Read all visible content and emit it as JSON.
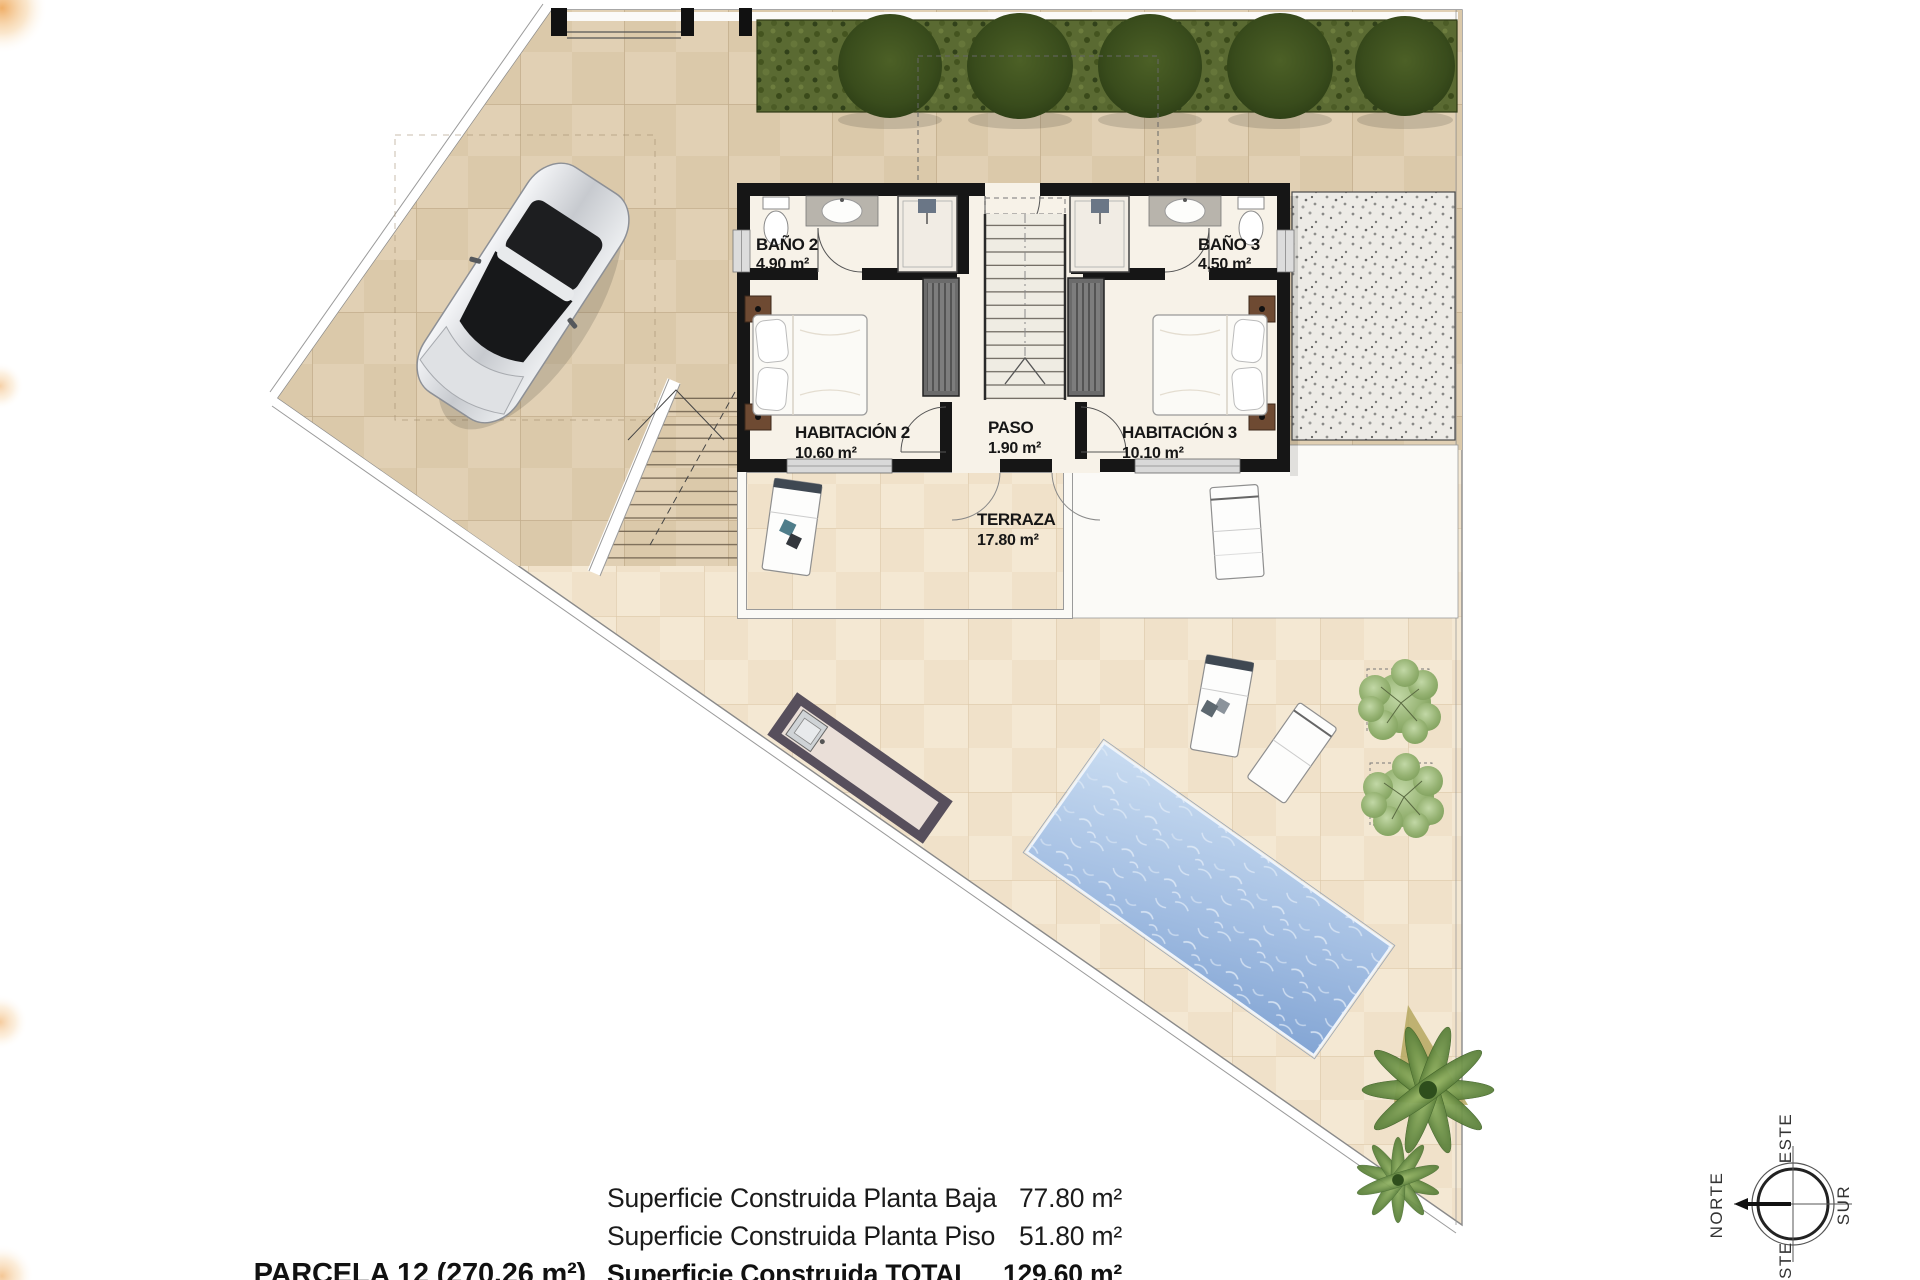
{
  "plan": {
    "rooms": [
      {
        "id": "bano2",
        "name": "BAÑO 2",
        "area": "4.90 m²"
      },
      {
        "id": "bano3",
        "name": "BAÑO 3",
        "area": "4.50 m²"
      },
      {
        "id": "habitacion2",
        "name": "HABITACIÓN 2",
        "area": "10.60 m²"
      },
      {
        "id": "paso",
        "name": "PASO",
        "area": "1.90 m²"
      },
      {
        "id": "habitacion3",
        "name": "HABITACIÓN 3",
        "area": "10.10 m²"
      },
      {
        "id": "terraza",
        "name": "TERRAZA",
        "area": "17.80 m²"
      }
    ]
  },
  "summary": {
    "parcel_label": "PARCELA 12 (270.26 m²)",
    "rows": [
      {
        "label": "Superficie Construida Planta Baja",
        "value": "77.80 m²"
      },
      {
        "label": "Superficie Construida Planta Piso",
        "value": "51.80 m²"
      },
      {
        "label": "Superficie Construida TOTAL",
        "value": "129.60 m²"
      }
    ]
  },
  "compass": {
    "north": "NORTE",
    "east": "ESTE",
    "south": "SUR",
    "west": "OESTE"
  },
  "colors": {
    "paving_dark": "#e1d0b4",
    "paving_light": "#f4e8d3",
    "hedge_green": "#5a6a32",
    "pool_water": "#97b5dd",
    "wall_black": "#161616",
    "wood_brown": "#6e4a32",
    "accent_amber": "#f2a954"
  }
}
